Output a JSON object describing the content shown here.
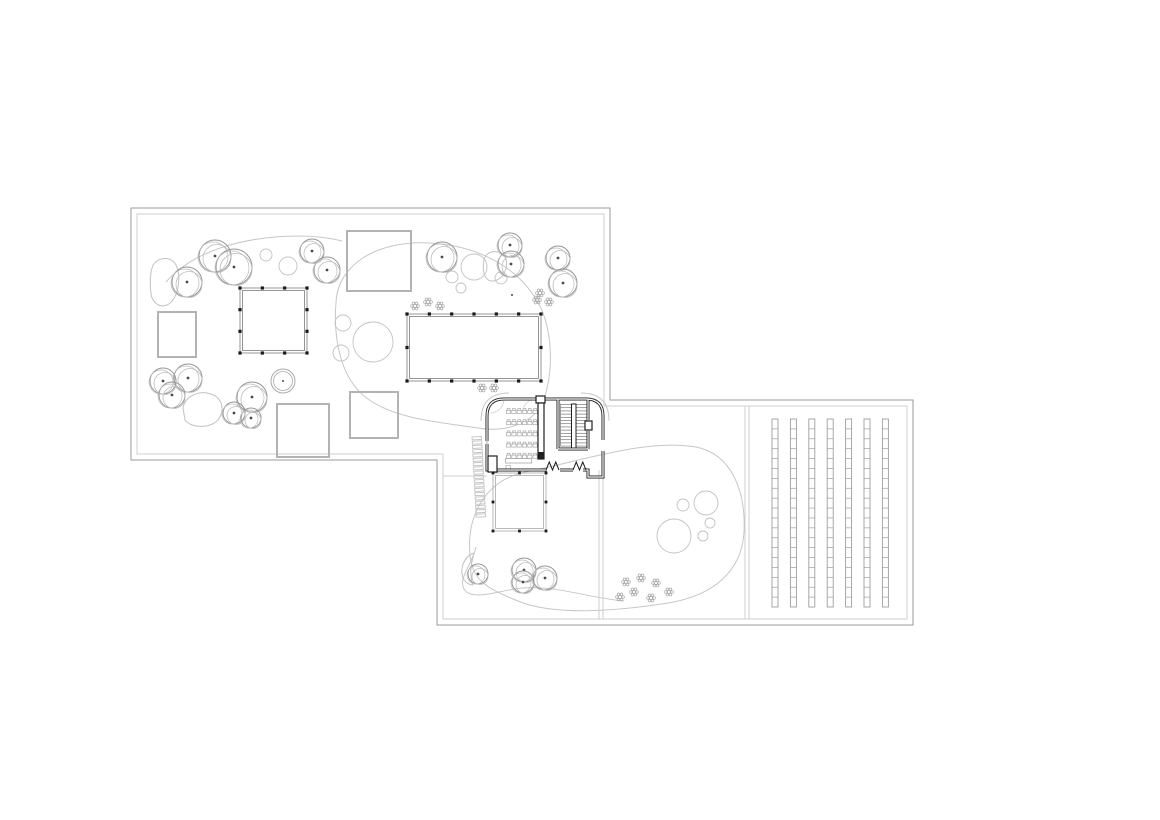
{
  "canvas": {
    "w": 1160,
    "h": 820,
    "bg": "#ffffff"
  },
  "palette": {
    "boundary_outer": "#9b9b9b",
    "boundary_inner": "#cfcfcf",
    "pavilion_gray": "#b3b3b3",
    "colonnade_line": "#8a8a8a",
    "column_dot": "#1a1a1a",
    "tree_line": "#969696",
    "tree_light": "#bcbcbc",
    "shrub_line": "#c2c2c2",
    "path_line": "#c7c7c7",
    "building_line": "#1f1f1f",
    "stair_line": "#777777",
    "furniture_line": "#a9a9a9",
    "strip_line": "#9e9e9e",
    "flower_line": "#aaaaaa",
    "dot_color": "#4a4a4a"
  },
  "site": {
    "outer_boundary": [
      [
        131,
        208
      ],
      [
        610,
        208
      ],
      [
        610,
        400
      ],
      [
        913,
        400
      ],
      [
        913,
        625
      ],
      [
        437,
        625
      ],
      [
        437,
        460
      ],
      [
        131,
        460
      ]
    ],
    "inner_boundary": [
      [
        137,
        214
      ],
      [
        604,
        214
      ],
      [
        604,
        406
      ],
      [
        907,
        406
      ],
      [
        907,
        619
      ],
      [
        443,
        619
      ],
      [
        443,
        454
      ],
      [
        137,
        454
      ]
    ],
    "divider_lines": [
      {
        "x1": 745,
        "y1": 406,
        "x2": 745,
        "y2": 619
      },
      {
        "x1": 749,
        "y1": 406,
        "x2": 749,
        "y2": 619
      },
      {
        "x1": 599,
        "y1": 470,
        "x2": 599,
        "y2": 619
      },
      {
        "x1": 603,
        "y1": 470,
        "x2": 603,
        "y2": 619
      }
    ],
    "extra_lines": [
      [
        443,
        476,
        487,
        476
      ]
    ]
  },
  "landscape": {
    "meadows": [
      "M 336,302 C 338,264 378,240 430,243 C 482,246 522,270 541,308 C 553,336 553,372 544,399 C 536,422 508,433 478,428 C 438,422 396,419 368,399 C 341,380 333,340 336,302 Z",
      "M 470,556 C 466,512 488,478 530,471 C 574,463 646,438 696,447 C 732,454 746,492 744,532 C 742,572 712,596 668,603 C 624,610 556,617 518,601 C 489,589 473,582 470,556 Z"
    ],
    "curves": [
      "M 166,282 C 192,252 242,236 300,236 C 318,236 330,238 342,241",
      "M 476,547 C 472,565 458,578 464,589 C 472,602 500,590 522,588 C 556,585 588,598 624,601"
    ],
    "blobs": [
      "M 152,268 C 155,257 171,255 176,265 C 181,275 179,293 172,301 C 165,310 153,306 151,294 C 150,285 150,275 152,268 Z",
      "M 484,259 C 487,250 500,249 505,257 C 509,265 505,276 497,280 C 488,284 481,277 484,259 Z",
      "M 183,408 C 185,396 199,390 211,394 C 223,398 225,411 218,420 C 209,429 191,428 185,420 Z",
      "M 464,580 C 459,570 463,557 474,553 C 471,565 469,574 473,585 C 470,585 466,583 464,580 Z"
    ],
    "trees": [
      [
        187,
        282,
        15
      ],
      [
        215,
        256,
        16
      ],
      [
        234,
        267,
        18
      ],
      [
        312,
        251,
        12
      ],
      [
        327,
        270,
        13
      ],
      [
        442,
        257,
        15
      ],
      [
        510,
        245,
        12
      ],
      [
        511,
        264,
        13
      ],
      [
        558,
        258,
        12
      ],
      [
        563,
        283,
        14
      ],
      [
        163,
        381,
        13
      ],
      [
        188,
        378,
        14
      ],
      [
        172,
        395,
        13
      ],
      [
        252,
        397,
        15
      ],
      [
        234,
        413,
        11
      ],
      [
        251,
        418,
        10
      ],
      [
        478,
        574,
        10
      ],
      [
        524,
        570,
        12
      ],
      [
        523,
        582,
        11
      ],
      [
        545,
        578,
        12
      ]
    ],
    "shrubs": [
      [
        266,
        255,
        6
      ],
      [
        288,
        266,
        9
      ],
      [
        474,
        267,
        13
      ],
      [
        452,
        277,
        6
      ],
      [
        461,
        288,
        5
      ],
      [
        501,
        278,
        6
      ],
      [
        343,
        323,
        8
      ],
      [
        341,
        353,
        8
      ],
      [
        373,
        342,
        20
      ],
      [
        683,
        505,
        6
      ],
      [
        706,
        503,
        12
      ],
      [
        710,
        523,
        5
      ],
      [
        703,
        536,
        5
      ],
      [
        674,
        536,
        17
      ]
    ],
    "planter": {
      "x": 283,
      "y": 381,
      "r1": 12,
      "r2": 9.5
    },
    "flowers": [
      [
        415,
        306
      ],
      [
        428,
        302
      ],
      [
        440,
        306
      ],
      [
        540,
        293
      ],
      [
        537,
        300
      ],
      [
        549,
        302
      ],
      [
        482,
        388
      ],
      [
        494,
        388
      ],
      [
        626,
        582
      ],
      [
        641,
        578
      ],
      [
        656,
        583
      ],
      [
        620,
        597
      ],
      [
        634,
        592
      ],
      [
        651,
        598
      ],
      [
        669,
        592
      ]
    ],
    "point_dots": [
      [
        512,
        295
      ]
    ]
  },
  "pavilions": {
    "plain": [
      {
        "x": 347,
        "y": 231,
        "w": 64,
        "h": 60
      },
      {
        "x": 158,
        "y": 312,
        "w": 38,
        "h": 45
      },
      {
        "x": 277,
        "y": 404,
        "w": 52,
        "h": 53
      },
      {
        "x": 350,
        "y": 392,
        "w": 48,
        "h": 46
      }
    ],
    "colonnade": [
      {
        "x": 240,
        "y": 288,
        "w": 67,
        "h": 65,
        "nx": 3,
        "ny": 3
      },
      {
        "x": 407,
        "y": 314,
        "w": 134,
        "h": 67,
        "nx": 6,
        "ny": 2
      }
    ],
    "canopy": {
      "x": 493,
      "y": 473,
      "w": 53,
      "h": 58,
      "nx": 2,
      "ny": 2
    }
  },
  "garden_strips": {
    "x0": 772,
    "pitch": 18.4,
    "w": 6,
    "y": 419,
    "h": 188,
    "cells": 19,
    "count": 7
  },
  "building": {
    "walls_heavy": [
      "M 487,441 L 487,416 Q 487,399 504,399 L 536,399",
      "M 545,399 L 586,399 Q 603,399 603,416 L 603,440",
      "M 603,451 L 603,477 L 588,477 L 588,470 L 583,470",
      "M 573,470 L 560,470",
      "M 547,470 L 487,470 L 487,444",
      "M 558,399 L 558,449",
      "M 558,449 L 588,449",
      "M 588,399 L 588,420",
      "M 588,431 L 588,449"
    ],
    "piers": [
      [
        536,
        396,
        9,
        7
      ],
      [
        585,
        421,
        7,
        9
      ],
      [
        488,
        456,
        9,
        16
      ]
    ],
    "glazing": [
      [
        487,
        424,
        487,
        444
      ]
    ],
    "bar": {
      "x": 538,
      "y": 403,
      "w": 6,
      "h": 56,
      "fill_h": 7
    },
    "stair": {
      "x1": 560.5,
      "x2": 571.5,
      "x3": 576,
      "x4": 587,
      "y0": 404.5,
      "dy": 3.2,
      "n": 14,
      "divider": [
        571.5,
        404,
        4.5,
        44
      ]
    },
    "doors_m": [
      [
        546,
        470,
        13
      ],
      [
        573,
        470,
        13
      ]
    ],
    "swing_arcs": [
      "M 536,399 A 13,13 0 0 0 523,411",
      "M 504,399 A 14,14 0 0 1 490,413"
    ],
    "canopy_arcs": [
      "M 481,421 Q 481,393 509,393",
      "M 581,393 Q 609,393 609,421"
    ],
    "chairs": {
      "x0": 506.5,
      "dx": 5.3,
      "y0": 408.5,
      "dy": 11.2,
      "rows": 5,
      "cols": 6
    },
    "desk": [
      505.5,
      458.5,
      26,
      4.5
    ],
    "teacher_chair": [
      506,
      465.5,
      4.5,
      5
    ],
    "trellis": {
      "x": 472,
      "y": 437,
      "n": 19,
      "dy": 4.3,
      "w": 9.5,
      "h": 2.9,
      "rot": -3
    }
  }
}
